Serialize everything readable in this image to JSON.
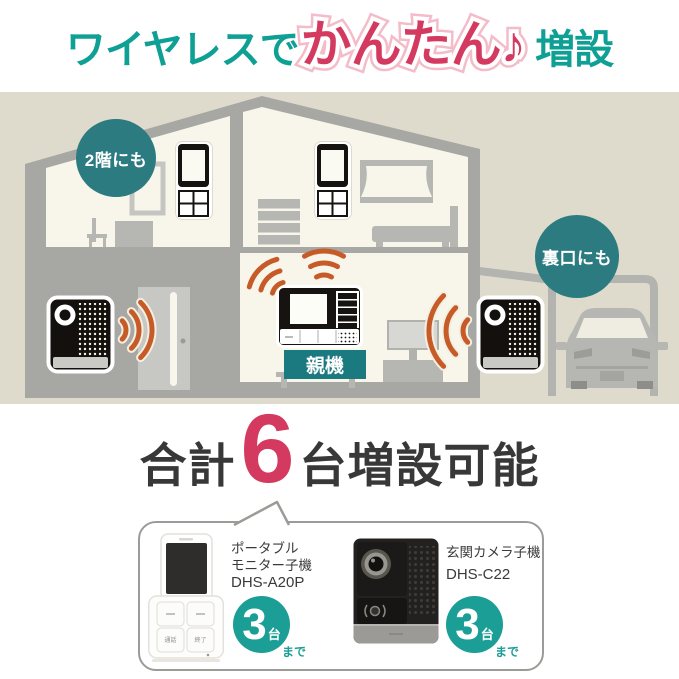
{
  "title": {
    "prefix": "ワイヤレスで",
    "highlight": "かんたん♪",
    "suffix": "増設"
  },
  "scene": {
    "badge_second_floor": "2階にも",
    "badge_back_door": "裏口にも",
    "parent_unit_label": "親機"
  },
  "summary": {
    "prefix": "合計",
    "count": "6",
    "suffix": "台増設可能"
  },
  "products": {
    "portable_monitor": {
      "name_line1": "ポータブル",
      "name_line2": "モニター子機",
      "model": "DHS-A20P",
      "max_count": "3",
      "count_unit": "台",
      "count_suffix": "まで",
      "button_talk": "通話",
      "button_end": "終了"
    },
    "entrance_camera": {
      "name": "玄関カメラ子機",
      "model": "DHS-C22",
      "max_count": "3",
      "count_unit": "台",
      "count_suffix": "まで"
    }
  },
  "colors": {
    "brand_teal": "#0fa095",
    "badge_teal": "#2b7b80",
    "label_teal": "#1a7a7f",
    "circle_teal": "#1b9e95",
    "accent_red": "#d4395f",
    "halo_pink": "#f4bcc9",
    "text_dark": "#383838",
    "signal_orange": "#c75b28",
    "scene_beige": "#dfdbcc",
    "wall_gray": "#a7a7a3",
    "room_cream": "#f8f6ea"
  }
}
